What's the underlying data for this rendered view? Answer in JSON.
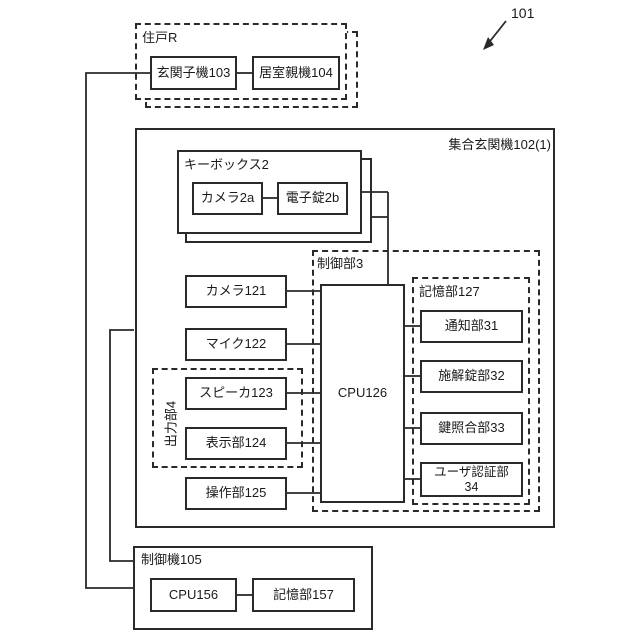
{
  "figure": {
    "ref_number": "101",
    "unit_r": {
      "label": "住戸R",
      "door_unit": "玄関子機103",
      "room_unit": "居室親機104"
    },
    "entrance_unit": {
      "label": "集合玄関機102(1)",
      "keybox": {
        "label": "キーボックス2",
        "camera": "カメラ2a",
        "lock": "電子錠2b"
      },
      "camera": "カメラ121",
      "mic": "マイク122",
      "speaker": "スピーカ123",
      "display": "表示部124",
      "operation": "操作部125",
      "output_unit_label": "出力部4",
      "control_unit": {
        "label": "制御部3",
        "cpu": "CPU126"
      },
      "memory_unit": {
        "label": "記憶部127",
        "notify": "通知部31",
        "lock_ctrl": "施解錠部32",
        "key_match": "鍵照合部33",
        "user_auth": "ユーザ認証部\n34"
      }
    },
    "controller": {
      "label": "制御機105",
      "cpu": "CPU156",
      "memory": "記憶部157"
    }
  }
}
